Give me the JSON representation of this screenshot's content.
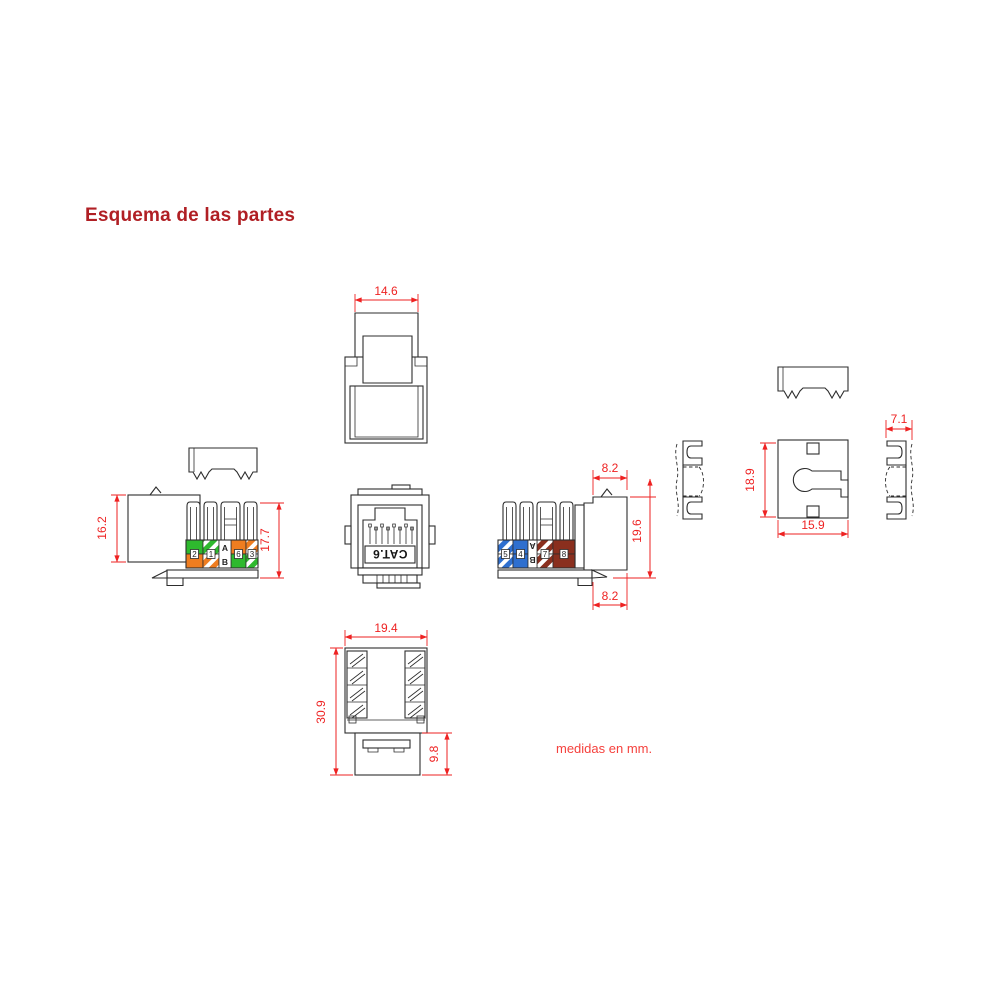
{
  "page": {
    "title": "Esquema de las partes",
    "units_note": "medidas en mm."
  },
  "colors": {
    "title_red": "#b01f24",
    "dimension_red": "#ee2222",
    "outline": "#2d2d2d",
    "wire_green": "#2eb92e",
    "wire_orange": "#ef7d20",
    "wire_blue": "#2e6fcf",
    "wire_brown": "#8a2f1e",
    "background": "#ffffff"
  },
  "views": {
    "front_top": {
      "dim_width": "14.6"
    },
    "side_a": {
      "dim_body_height": "16.2",
      "dim_total_height": "17.7",
      "wiring": {
        "row_top": "A",
        "row_bottom": "B",
        "pins": [
          "2",
          "1",
          "6",
          "3"
        ],
        "colors_top": [
          "green",
          "green-white",
          "orange",
          "orange-white"
        ],
        "colors_bottom": [
          "orange",
          "orange-white",
          "green",
          "green-white"
        ]
      }
    },
    "front": {
      "label": "CAT.6"
    },
    "side_b": {
      "dim_top_width": "8.2",
      "dim_height": "19.6",
      "dim_bottom_width": "8.2",
      "wiring": {
        "row_top": "A",
        "row_bottom": "B",
        "pins": [
          "5",
          "4",
          "7",
          "8"
        ],
        "colors_top": [
          "blue-white",
          "blue",
          "brown-white",
          "brown"
        ],
        "colors_bottom": [
          "blue-white",
          "blue",
          "brown-white",
          "brown"
        ]
      }
    },
    "dust_cap": {
      "dim_height": "18.9",
      "dim_width": "15.9",
      "dim_depth": "7.1"
    },
    "bottom": {
      "dim_width": "19.4",
      "dim_total_height": "30.9",
      "dim_base_height": "9.8"
    }
  }
}
